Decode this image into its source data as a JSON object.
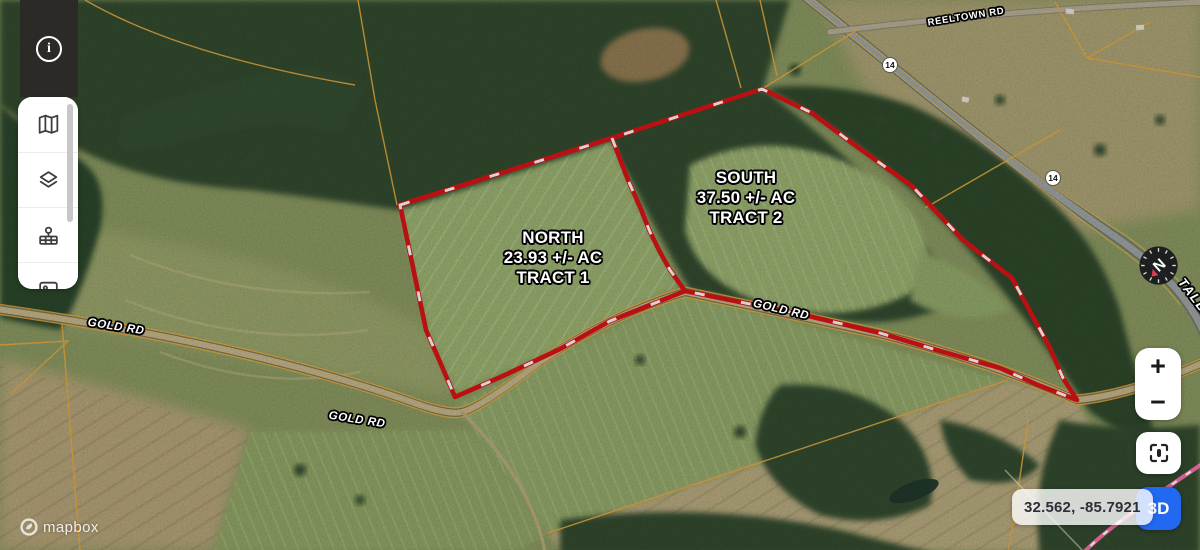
{
  "sidebar": {
    "info_icon": "i",
    "tools": [
      {
        "icon": "map"
      },
      {
        "icon": "layers"
      },
      {
        "icon": "legend-pin"
      },
      {
        "icon": "imagery"
      }
    ]
  },
  "map": {
    "tracts": [
      {
        "title": "NORTH",
        "acreage": "23.93 +/- AC",
        "tract": "TRACT 1"
      },
      {
        "title": "SOUTH",
        "acreage": "37.50 +/- AC",
        "tract": "TRACT 2"
      }
    ],
    "roads": {
      "gold": "GOLD RD",
      "reeltown": "REELTOWN RD",
      "tallapoosa": "TALLA"
    },
    "highway_shield": "14"
  },
  "controls": {
    "zoom_in": "+",
    "zoom_out": "−",
    "three_d": "3D",
    "compass": "N",
    "coordinates": "32.562, -85.7921"
  },
  "attribution": {
    "brand": "mapbox"
  },
  "colors": {
    "boundary_red": "#d31316",
    "boundary_pink": "#ee6ea6",
    "parcel_yellow": "#e2a73d",
    "accent_blue": "#2368f0"
  }
}
